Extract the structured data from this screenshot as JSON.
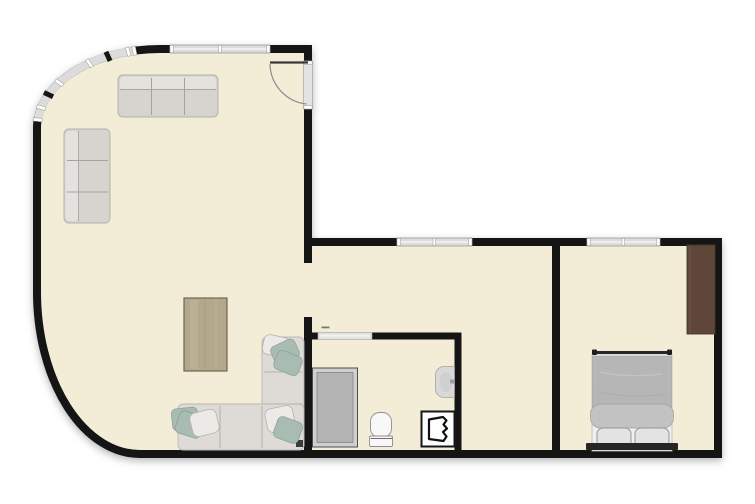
{
  "meta": {
    "type": "2d-floor-plan",
    "canvas_width": "755",
    "canvas_height": "504"
  },
  "colors": {
    "background": "#ffffff",
    "wall": "#151515",
    "floor": "#f3edd8",
    "window": "#dcdcdc",
    "door": "#e3e3e3",
    "sofa": "#d6d4cf",
    "sofa_back": "#e4e2de",
    "sectional": "#dedbd6",
    "pillow_white": "#eceae7",
    "pillow_sage": "#a8bcb2",
    "table": "#b3a78c",
    "shower_frame": "#cfcfcf",
    "shower": "#b4b4b4",
    "fixture": "#f8f8f8",
    "sink": "#d9d9d9",
    "appliance": "#fdfdfd",
    "wardrobe": "#5e4738",
    "duvet": "#b6b6b6",
    "duvet_fold": "#c2c2c2",
    "bed_base": "#efefef",
    "bed_pillow": "#e3e3e3",
    "headboard": "#262626"
  },
  "rooms": [
    {
      "name": "living-room"
    },
    {
      "name": "hall"
    },
    {
      "name": "bathroom"
    },
    {
      "name": "bedroom"
    }
  ],
  "furniture": [
    {
      "room": "living-room",
      "item": "three-seat-sofa-top"
    },
    {
      "room": "living-room",
      "item": "three-seat-sofa-left"
    },
    {
      "room": "living-room",
      "item": "coffee-table"
    },
    {
      "room": "living-room",
      "item": "corner-sectional-sofa"
    },
    {
      "room": "bathroom",
      "item": "shower"
    },
    {
      "room": "bathroom",
      "item": "toilet"
    },
    {
      "room": "bathroom",
      "item": "wall-sink"
    },
    {
      "room": "bathroom",
      "item": "washing-machine"
    },
    {
      "room": "bedroom",
      "item": "double-bed"
    },
    {
      "room": "bedroom",
      "item": "wardrobe"
    }
  ],
  "architecture": [
    "entry-door",
    "hall-opening",
    "bathroom-sliding-door",
    "curved-window-band",
    "living-room-window",
    "hall-window",
    "bedroom-window"
  ]
}
